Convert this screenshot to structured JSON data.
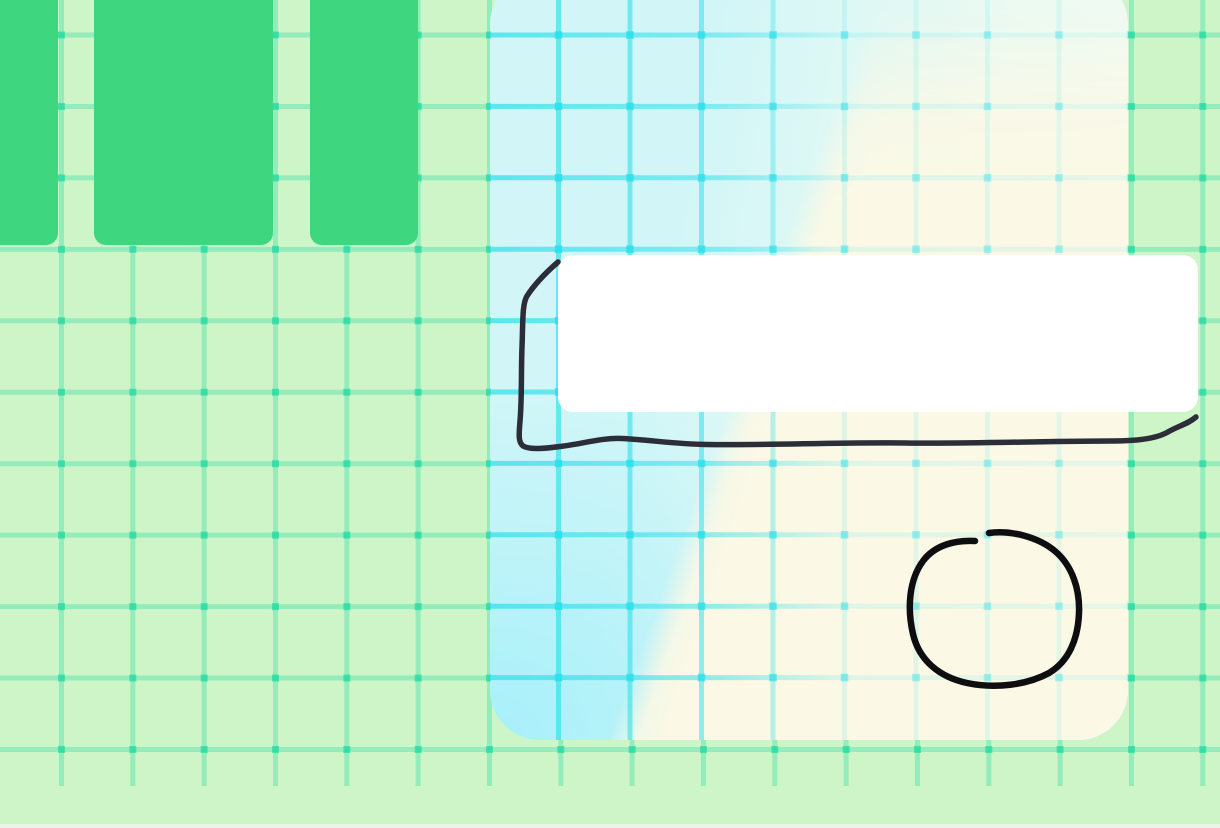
{
  "scene": {
    "description": "Pastel whiteboard canvas: light-green grid wallpaper, three green tiles at top-left, large cyan-to-cream gradient grid panel, white rounded card, hand-drawn black ink rectangle and circle annotations",
    "text_content": "none"
  },
  "palette": {
    "background": "#cdf5c7",
    "grid_green": "#14d6a0",
    "tile_green": "#3ed67f",
    "panel_cyan_deep": "#a7f0fa",
    "panel_cyan": "#d2f6f7",
    "panel_mint": "#ecfaf2",
    "panel_white": "#f3fbf3",
    "grid_cyan": "#2ee0ea",
    "cream": "#fbf8e5",
    "card_white": "#ffffff",
    "ink_dark": "#2b2e39",
    "ink_black": "#0e0e11",
    "bottom_edge": "#eef5ec"
  },
  "annotations": {
    "rectangle_stroke": {
      "shape": "hand-drawn open rectangle around white card",
      "color": "#2b2e39",
      "path": "M 558 262 C 550 269 536 282 527 296 C 522 304 523 323 522 347 C 521 373 522 399 520 421 C 519 434 518 442 523 446 C 530 450 545 448.5 560 446.5 C 582 444 602 437.5 622 438.5 C 650 440 676 444 706 444.5 C 770 445.5 838 442 906 443 C 964 444 1046 441 1112 441 C 1140 441 1157 438 1167 432.5 C 1178 426 1188 424 1196 417"
    },
    "circle_stroke": {
      "shape": "hand-drawn circle with small gap at top",
      "color": "#0e0e11",
      "path": "M 989 533 C 1011 530 1039 537 1056 552 C 1072 566 1080 589 1079 613 C 1078 639 1069 661 1049 673 C 1027 685 995 689 967 683 C 939 677 919 660 913 634 C 907 608 909 580 923 561 C 935 545 955 540 975 541"
    }
  }
}
